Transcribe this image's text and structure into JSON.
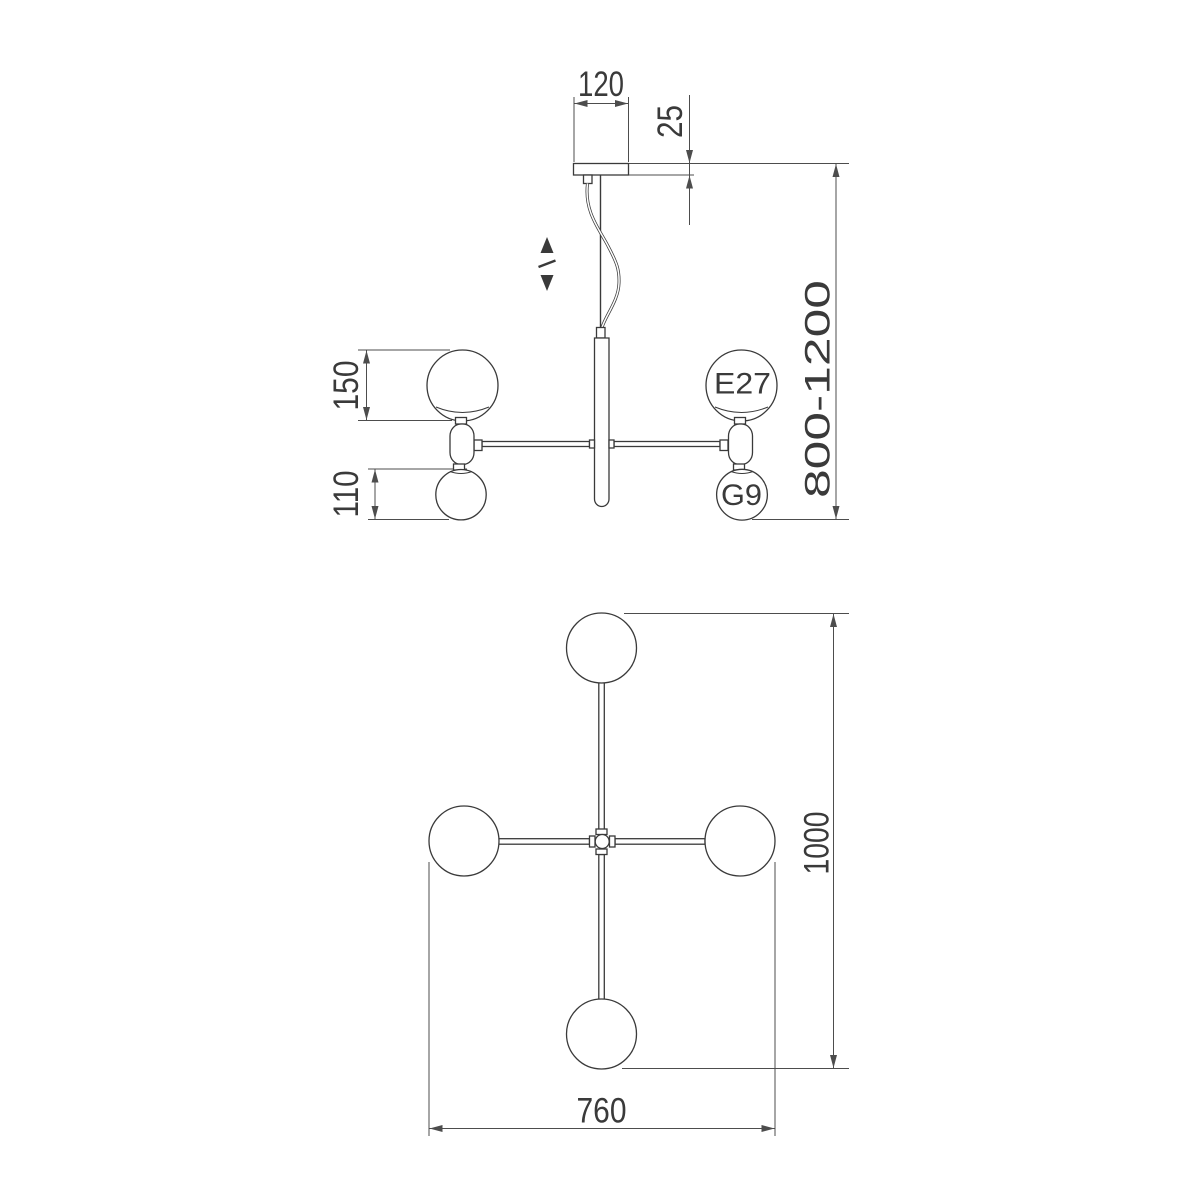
{
  "side_view": {
    "dimensions": {
      "canopy_width": "120",
      "canopy_thickness": "25",
      "height_range": "800-1200",
      "large_globe_diameter": "150",
      "small_globe_diameter": "110"
    },
    "socket_labels": {
      "large_globe": "E27",
      "small_globe": "G9"
    },
    "icons": {
      "height_adjust": "up-down-arrows"
    }
  },
  "plan_view": {
    "dimensions": {
      "overall_length": "1000",
      "overall_width": "760"
    }
  },
  "colors": {
    "background": "#ffffff",
    "object_line": "#3a3a3a",
    "dimension_line": "#4d4d4d",
    "text": "#3a3a3a"
  }
}
